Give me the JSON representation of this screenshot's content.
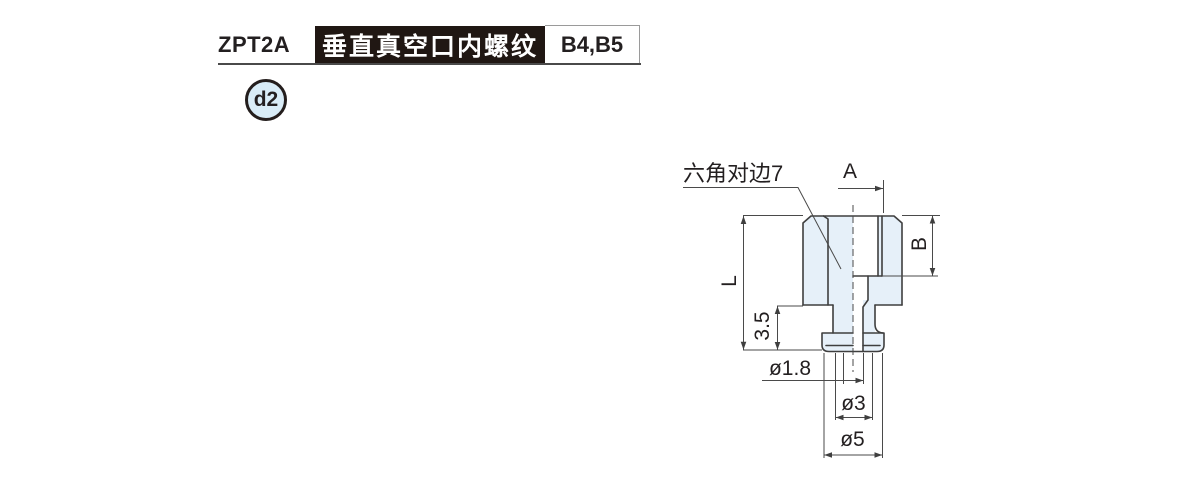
{
  "header": {
    "model": "ZPT2A",
    "title": "垂直真空口内螺纹",
    "codes": "B4,B5",
    "variant_badge": "d2"
  },
  "drawing": {
    "hex_note": "六角对边7",
    "dim_a": "A",
    "dim_b": "B",
    "dim_l": "L",
    "dim_height": "3.5",
    "dia_hole": "ø1.8",
    "dia_neck": "ø3",
    "dia_flange": "ø5"
  },
  "colors": {
    "header_bar_bg": "#201713",
    "header_bar_text": "#ffffff",
    "text": "#231f20",
    "part_fill": "#e6f0f9",
    "part_outline": "#3f3f3f",
    "dim_line": "#4a4a4a",
    "badge_fill": "#d9ecf7"
  }
}
